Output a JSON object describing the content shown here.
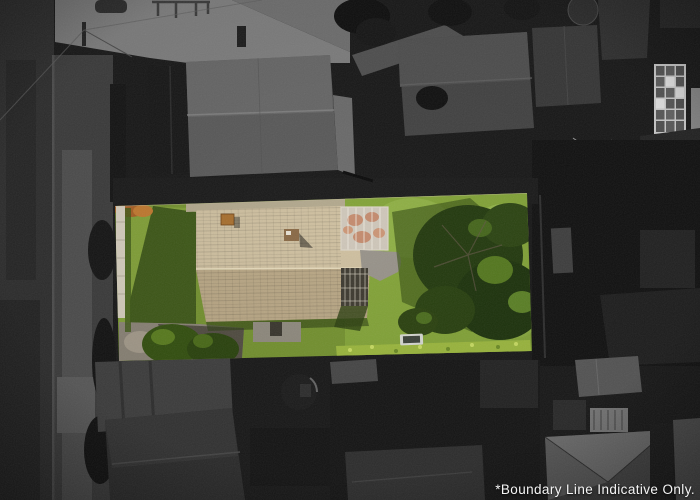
{
  "caption": {
    "text": "*Boundary Line Indicative Only."
  },
  "scene": {
    "kind": "aerial-property-photo",
    "highlight": "single property lot shown in color over grayscale neighborhood"
  },
  "colors": {
    "background": "#161616",
    "road": "#2e2e2e",
    "berm": "#3c3c3c",
    "footpath": "#4e4e4e",
    "concrete": "#7e7e7e",
    "building_roof": "#5a5a5a",
    "dark_roof": "#2f2f2f",
    "greenhouse_frame": "#cfcfcf",
    "lawn": "#74922f",
    "lawn_bright": "#83a438",
    "lawn_shadow": "#2f4811",
    "tree_dark": "#233a0e",
    "tree_light": "#55791f",
    "autumn_tree": "#a85f24",
    "roof_light": "#cfc0a0",
    "roof_dark": "#b9a785",
    "ridge": "#e6dabb",
    "chimney": "#a9702f",
    "deck_rust": "#b4552a",
    "pergola_panel": "#d6cfc0",
    "patio": "#98938a",
    "paving": "#8a8376",
    "fence": "#d6cfbe",
    "hedge": "#9cb83e",
    "vehicle": "#d7d9d2",
    "caption_text": "#f5f5f5"
  }
}
